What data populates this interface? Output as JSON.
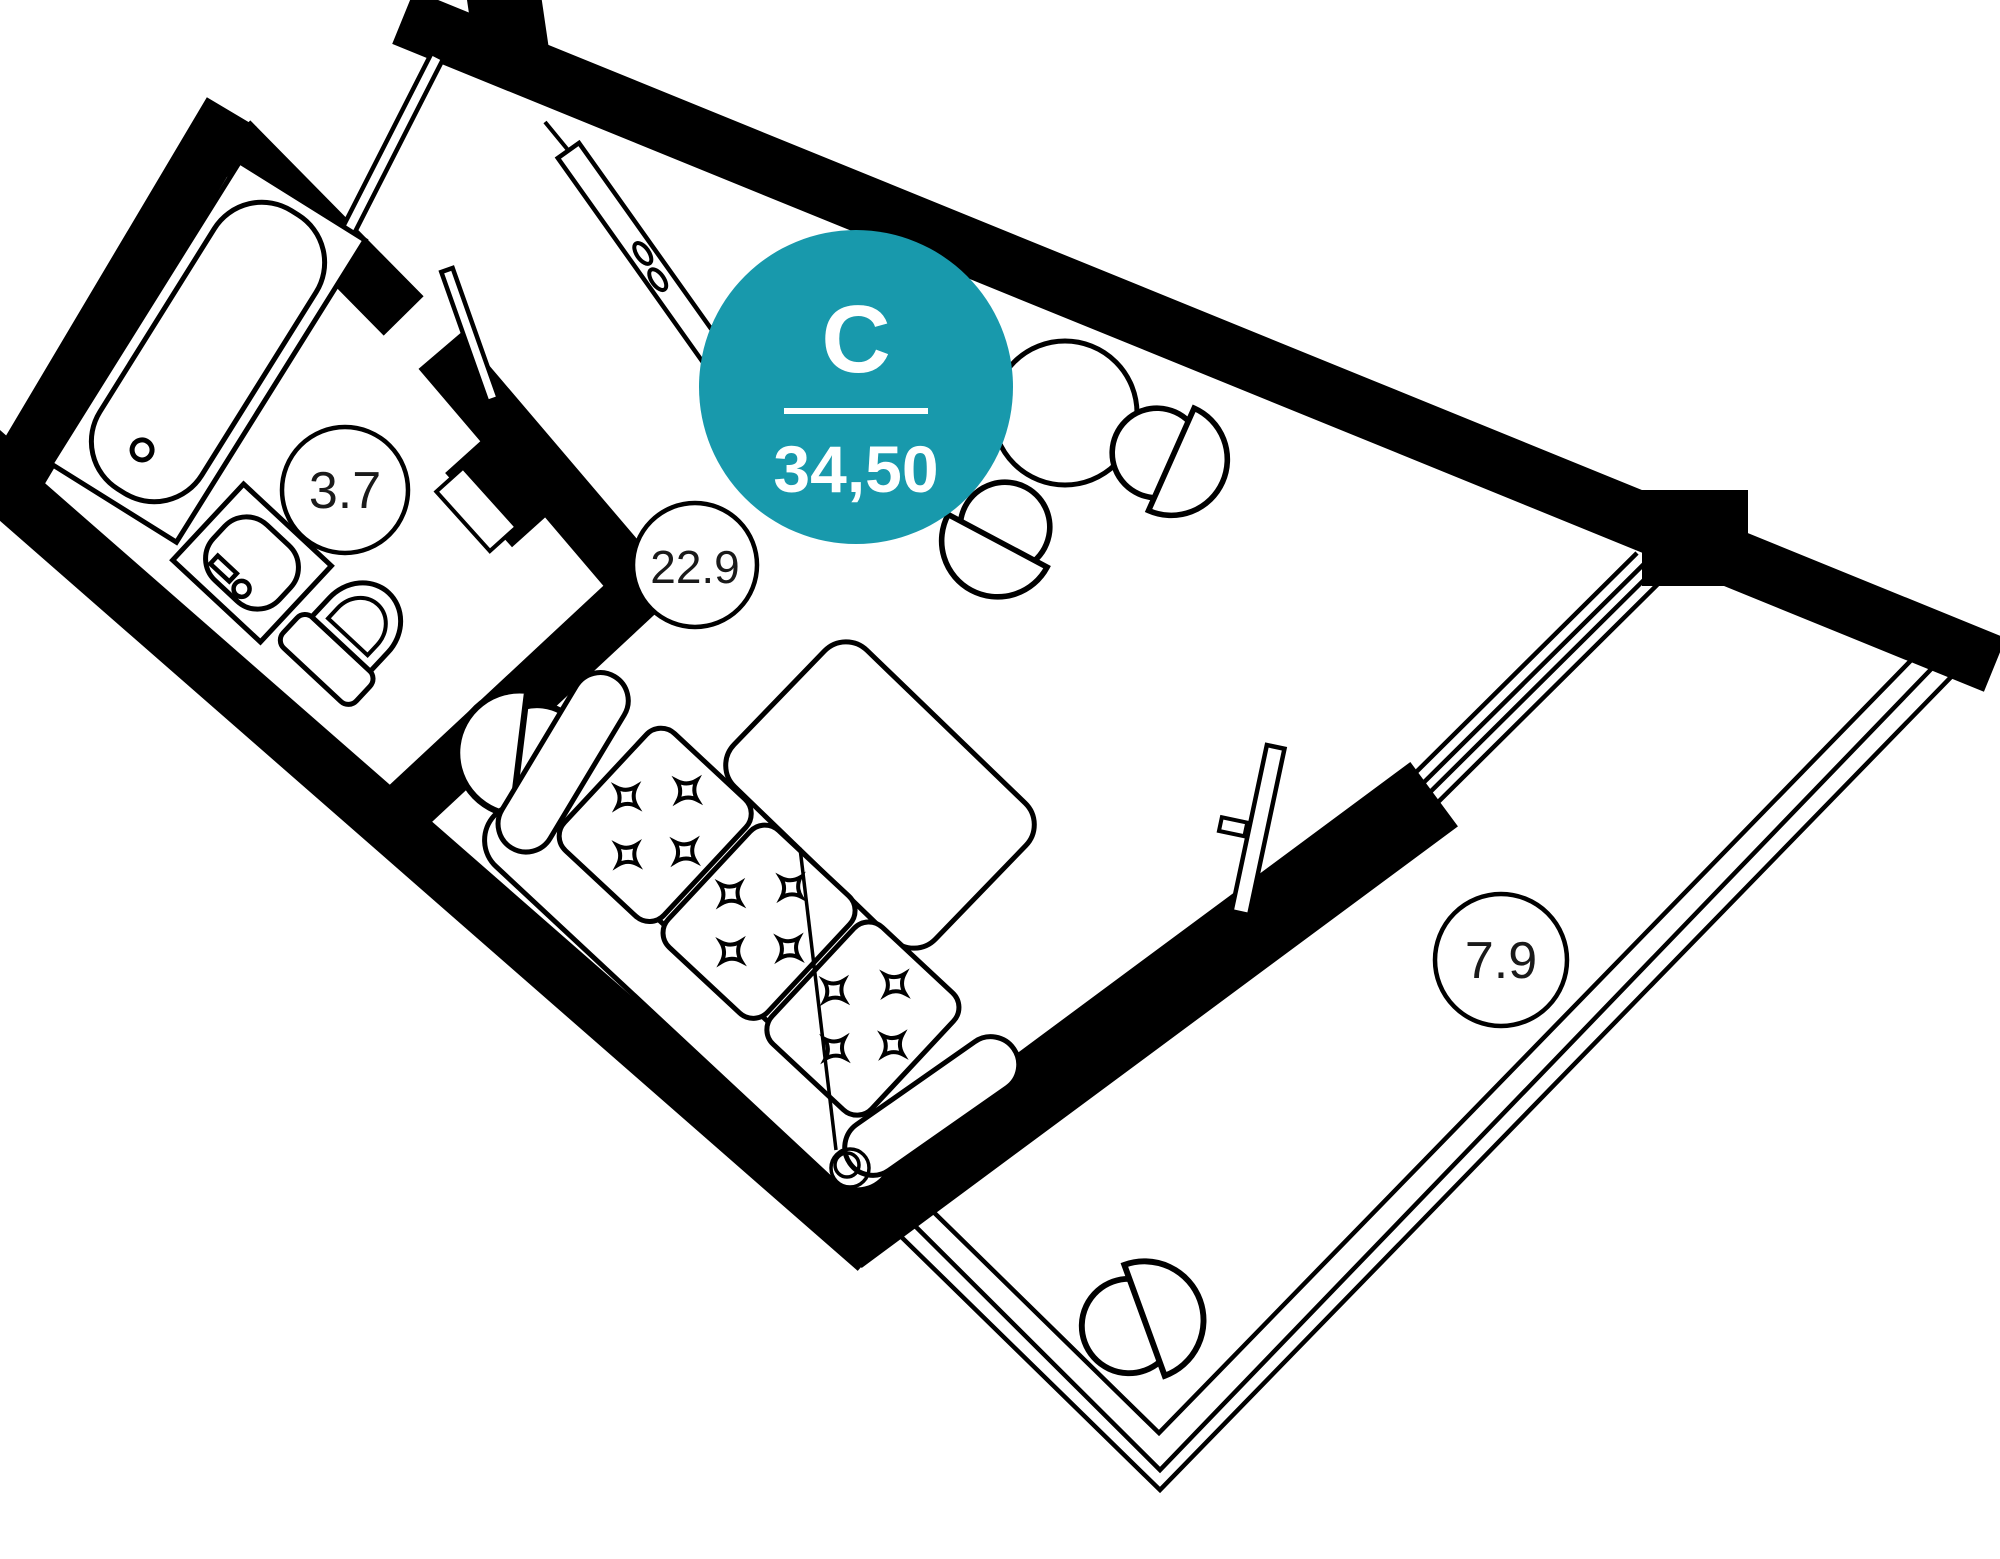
{
  "badge": {
    "letter": "С",
    "area": "34,50",
    "color": "#1899AC",
    "text_color": "#ffffff"
  },
  "rooms": [
    {
      "id": "bathroom",
      "area_label": "3.7"
    },
    {
      "id": "living-room",
      "area_label": "22.9"
    },
    {
      "id": "balcony",
      "area_label": "7.9"
    }
  ],
  "palette": {
    "walls": "#000000",
    "background": "#ffffff",
    "thin_line": "#000000"
  }
}
